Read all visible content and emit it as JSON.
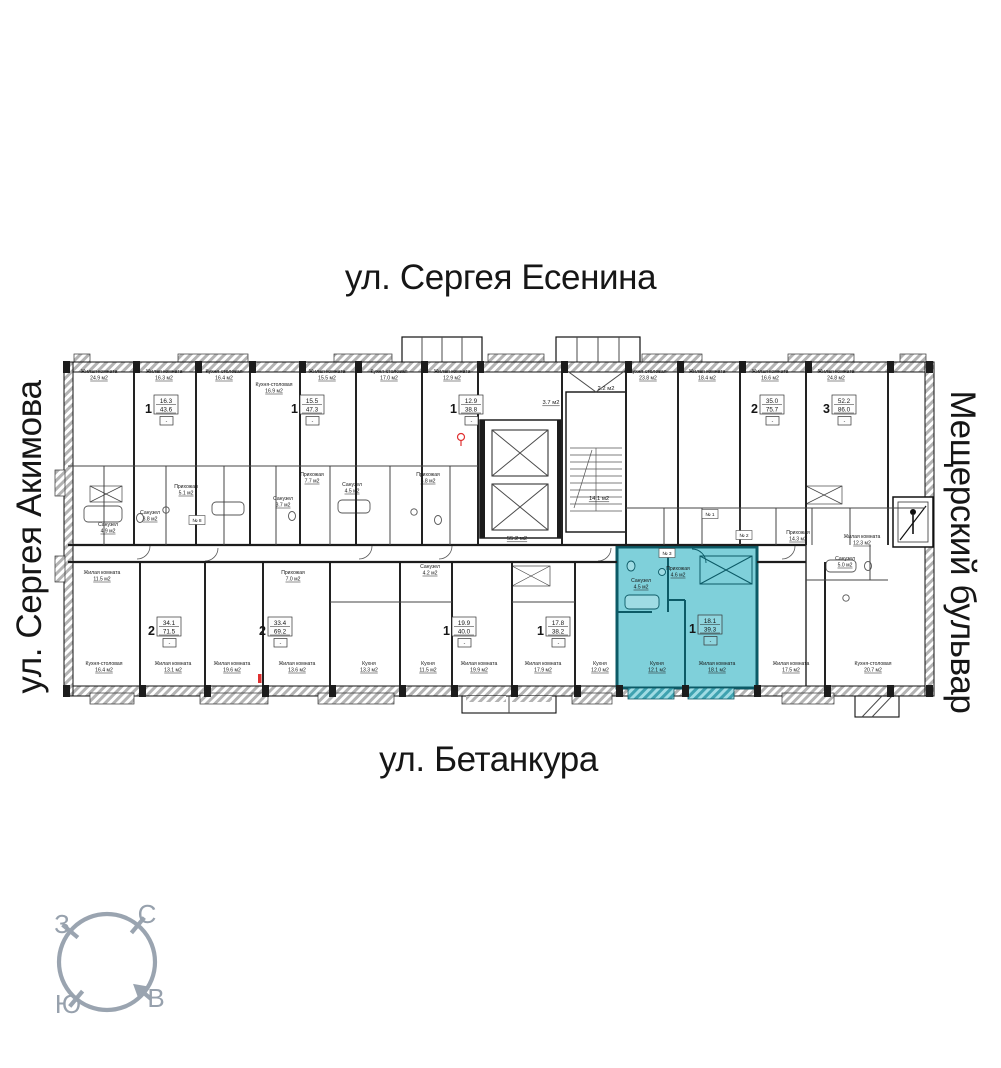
{
  "streets": {
    "top": "ул. Сергея Есенина",
    "left": "ул. Сергея Акимова",
    "right": "Мещерский бульвар",
    "bottom": "ул. Бетанкура"
  },
  "compass": {
    "north": "С",
    "south": "Ю",
    "west": "З",
    "east": "В"
  },
  "colors": {
    "highlight_fill": "#7fd0da",
    "highlight_wall": "#0c5a66",
    "wall": "#1c1c1c",
    "compass": "#9aa4b0",
    "marker_red": "#e03131"
  },
  "apartments": [
    {
      "rooms": "1",
      "living": "16.3",
      "total": "43.6",
      "x": 165,
      "y": 408,
      "highlighted": false
    },
    {
      "rooms": "1",
      "living": "15.5",
      "total": "47.3",
      "x": 311,
      "y": 408,
      "highlighted": false
    },
    {
      "rooms": "1",
      "living": "12.9",
      "total": "38.8",
      "x": 470,
      "y": 408,
      "highlighted": false
    },
    {
      "rooms": "2",
      "living": "35.0",
      "total": "75.7",
      "x": 771,
      "y": 408,
      "highlighted": false
    },
    {
      "rooms": "3",
      "living": "52.2",
      "total": "86.0",
      "x": 843,
      "y": 408,
      "highlighted": false
    },
    {
      "rooms": "2",
      "living": "34.1",
      "total": "71.5",
      "x": 168,
      "y": 630,
      "highlighted": false
    },
    {
      "rooms": "2",
      "living": "33.4",
      "total": "69.2",
      "x": 279,
      "y": 630,
      "highlighted": false
    },
    {
      "rooms": "1",
      "living": "19.9",
      "total": "40.0",
      "x": 463,
      "y": 630,
      "highlighted": false
    },
    {
      "rooms": "1",
      "living": "17.8",
      "total": "38.2",
      "x": 557,
      "y": 630,
      "highlighted": false
    },
    {
      "rooms": "1",
      "living": "18.1",
      "total": "39.3",
      "x": 709,
      "y": 628,
      "highlighted": true
    }
  ],
  "room_labels": [
    {
      "name": "Жилая комната",
      "area": "24.9 м2",
      "x": 99,
      "y": 373
    },
    {
      "name": "Жилая комната",
      "area": "16.3 м2",
      "x": 164,
      "y": 373
    },
    {
      "name": "Кухня-столовая",
      "area": "16.4 м2",
      "x": 224,
      "y": 373
    },
    {
      "name": "Кухня-столовая",
      "area": "16.9 м2",
      "x": 274,
      "y": 386
    },
    {
      "name": "Жилая комната",
      "area": "15.5 м2",
      "x": 327,
      "y": 373
    },
    {
      "name": "Кухня-столовая",
      "area": "17.0 м2",
      "x": 389,
      "y": 373
    },
    {
      "name": "Жилая комната",
      "area": "12.9 м2",
      "x": 452,
      "y": 373
    },
    {
      "name": "Кухня-столовая",
      "area": "23.8 м2",
      "x": 648,
      "y": 373
    },
    {
      "name": "Жилая комната",
      "area": "18.4 м2",
      "x": 707,
      "y": 373
    },
    {
      "name": "Жилая комната",
      "area": "16.6 м2",
      "x": 770,
      "y": 373
    },
    {
      "name": "Жилая комната",
      "area": "24.8 м2",
      "x": 836,
      "y": 373
    },
    {
      "name": "Кухня-столовая",
      "area": "16.4 м2",
      "x": 104,
      "y": 665
    },
    {
      "name": "Жилая комната",
      "area": "13.1 м2",
      "x": 173,
      "y": 665
    },
    {
      "name": "Жилая комната",
      "area": "19.6 м2",
      "x": 232,
      "y": 665
    },
    {
      "name": "Жилая комната",
      "area": "13.6 м2",
      "x": 297,
      "y": 665
    },
    {
      "name": "Кухня",
      "area": "13.3 м2",
      "x": 369,
      "y": 665
    },
    {
      "name": "Кухня",
      "area": "11.5 м2",
      "x": 428,
      "y": 665
    },
    {
      "name": "Жилая комната",
      "area": "19.9 м2",
      "x": 479,
      "y": 665
    },
    {
      "name": "Жилая комната",
      "area": "17.9 м2",
      "x": 543,
      "y": 665
    },
    {
      "name": "Кухня",
      "area": "12.0 м2",
      "x": 600,
      "y": 665
    },
    {
      "name": "Кухня",
      "area": "12.1 м2",
      "x": 657,
      "y": 665
    },
    {
      "name": "Жилая комната",
      "area": "18.1 м2",
      "x": 717,
      "y": 665
    },
    {
      "name": "Жилая комната",
      "area": "17.5 м2",
      "x": 791,
      "y": 665
    },
    {
      "name": "Кухня-столовая",
      "area": "20.7 м2",
      "x": 873,
      "y": 665
    },
    {
      "name": "Санузел",
      "area": "4.9 м2",
      "x": 108,
      "y": 526
    },
    {
      "name": "Прихожая",
      "area": "5.1 м2",
      "x": 186,
      "y": 488
    },
    {
      "name": "Санузел",
      "area": "3.8 м2",
      "x": 150,
      "y": 514
    },
    {
      "name": "Прихожая",
      "area": "7.7 м2",
      "x": 312,
      "y": 476
    },
    {
      "name": "Санузел",
      "area": "4.5 м2",
      "x": 352,
      "y": 486
    },
    {
      "name": "Санузел",
      "area": "3.7 м2",
      "x": 283,
      "y": 500
    },
    {
      "name": "Прихожая",
      "area": "5.8 м2",
      "x": 428,
      "y": 476
    },
    {
      "name": "Жилая комната",
      "area": "11.5 м2",
      "x": 102,
      "y": 574
    },
    {
      "name": "Прихожая",
      "area": "7.0 м2",
      "x": 293,
      "y": 574
    },
    {
      "name": "Санузел",
      "area": "4.2 м2",
      "x": 430,
      "y": 568
    },
    {
      "name": "Прихожая",
      "area": "14.3 м2",
      "x": 798,
      "y": 534
    },
    {
      "name": "Жилая комната",
      "area": "12.3 м2",
      "x": 862,
      "y": 538
    },
    {
      "name": "Санузел",
      "area": "5.0 м2",
      "x": 845,
      "y": 560
    },
    {
      "name": "Прихожая",
      "area": "4.6 м2",
      "x": 678,
      "y": 570
    },
    {
      "name": "Санузел",
      "area": "4.5 м2",
      "x": 641,
      "y": 582
    }
  ],
  "core_labels": [
    {
      "text": "55.2 м2",
      "x": 517,
      "y": 540
    },
    {
      "text": "14.1 м2",
      "x": 599,
      "y": 500
    },
    {
      "text": "2.2 м2",
      "x": 606,
      "y": 390
    },
    {
      "text": "3.7 м2",
      "x": 551,
      "y": 404
    }
  ],
  "unit_badges": [
    {
      "text": "№ 1",
      "x": 710,
      "y": 514
    },
    {
      "text": "№ 2",
      "x": 744,
      "y": 535
    },
    {
      "text": "№ 3",
      "x": 667,
      "y": 553
    },
    {
      "text": "№ 8",
      "x": 197,
      "y": 520
    }
  ]
}
